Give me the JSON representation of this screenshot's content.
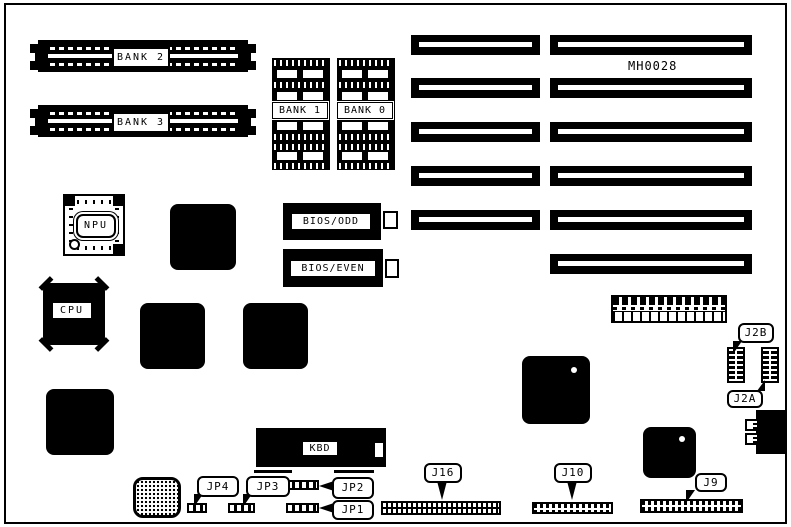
{
  "board": {
    "part_number": "MH0028",
    "simm_slots": [
      {
        "label": "BANK 2"
      },
      {
        "label": "BANK 3"
      }
    ],
    "dram_banks": [
      {
        "label": "BANK 1"
      },
      {
        "label": "BANK 0"
      }
    ],
    "chips": {
      "npu": {
        "label": "NPU"
      },
      "cpu": {
        "label": "CPU"
      },
      "bios_odd": {
        "label": "BIOS/ODD"
      },
      "bios_even": {
        "label": "BIOS/EVEN"
      },
      "kbd": {
        "label": "KBD"
      }
    },
    "callouts": {
      "jp4": {
        "label": "JP4"
      },
      "jp3": {
        "label": "JP3"
      },
      "jp2": {
        "label": "JP2"
      },
      "jp1": {
        "label": "JP1"
      },
      "j16": {
        "label": "J16"
      },
      "j10": {
        "label": "J10"
      },
      "j9": {
        "label": "J9"
      },
      "j2b": {
        "label": "J2B"
      },
      "j2a": {
        "label": "J2A"
      }
    },
    "expansion_slots": {
      "left_column_count": 5,
      "right_column_count": 6
    },
    "colors": {
      "ink": "#000000",
      "paper": "#ffffff"
    }
  }
}
